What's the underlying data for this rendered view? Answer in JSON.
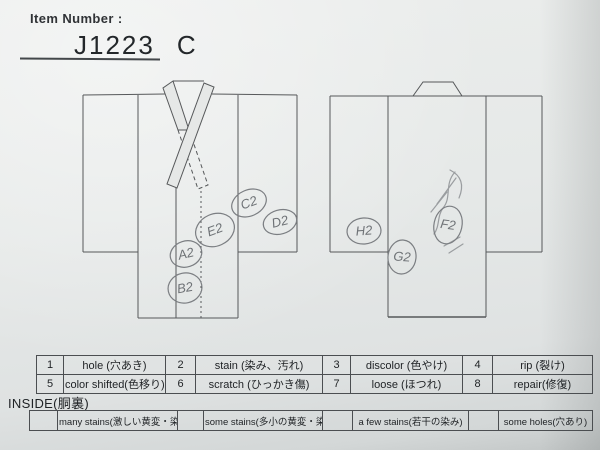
{
  "photo": {
    "header": {
      "label": "Item Number :",
      "item_number": "J1223",
      "item_suffix": "C"
    },
    "diagrams": {
      "front_name": "kimono-front-diagram",
      "back_name": "kimono-back-diagram",
      "front_marks": [
        {
          "code": "A2"
        },
        {
          "code": "B2"
        },
        {
          "code": "C2"
        },
        {
          "code": "D2"
        },
        {
          "code": "E2"
        }
      ],
      "back_marks": [
        {
          "code": "F2"
        },
        {
          "code": "G2"
        },
        {
          "code": "H2"
        }
      ]
    },
    "defect_table": {
      "row1": [
        {
          "num": "1",
          "label": "hole (穴あき)"
        },
        {
          "num": "2",
          "label": "stain (染み、汚れ)"
        },
        {
          "num": "3",
          "label": "discolor (色やけ)"
        },
        {
          "num": "4",
          "label": "rip (裂け)"
        }
      ],
      "row2": [
        {
          "num": "5",
          "label": "color shifted(色移り)"
        },
        {
          "num": "6",
          "label": "scratch (ひっかき傷)"
        },
        {
          "num": "7",
          "label": "loose (ほつれ)"
        },
        {
          "num": "8",
          "label": "repair(修復)"
        }
      ]
    },
    "inside": {
      "title": "INSIDE(胴裏)",
      "options": [
        "many stains(激しい黄変・染み)",
        "some stains(多小の黄変・染み)",
        "a few stains(若干の染み)",
        "some holes(穴あり)"
      ]
    },
    "colors": {
      "paper": "#e6e8e7",
      "diagram_line": "#56585a",
      "pencil": "#8d9093",
      "ink": "#1e2124"
    }
  }
}
